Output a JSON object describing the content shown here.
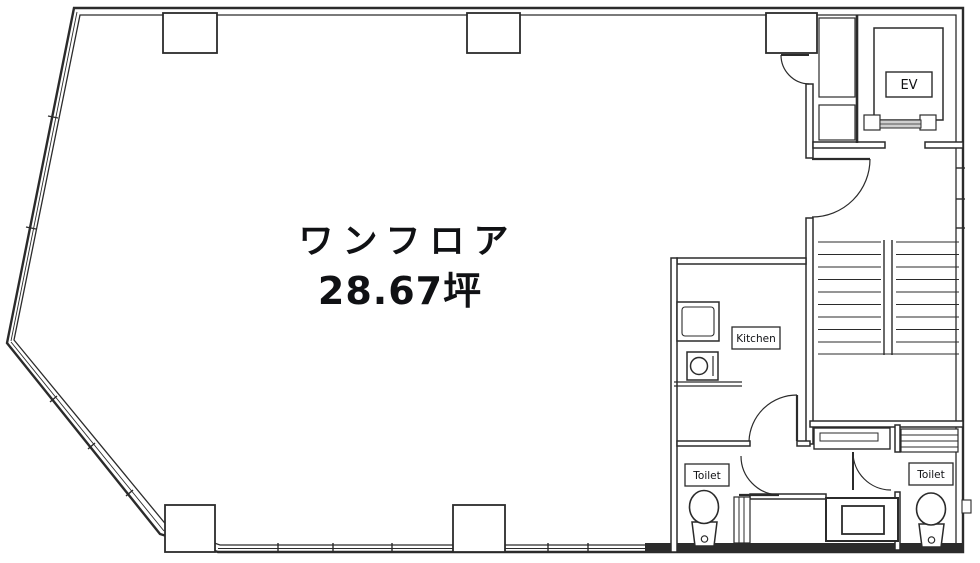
{
  "floorplan": {
    "area_label": {
      "line1": "ワンフロア",
      "line2": "28.67坪"
    },
    "rooms": {
      "elevator": "EV",
      "kitchen": "Kitchen",
      "toilet_left": "Toilet",
      "toilet_right": "Toilet"
    },
    "colors": {
      "background": "#ffffff",
      "wall_line": "#2b2b2b",
      "text": "#101114"
    }
  }
}
